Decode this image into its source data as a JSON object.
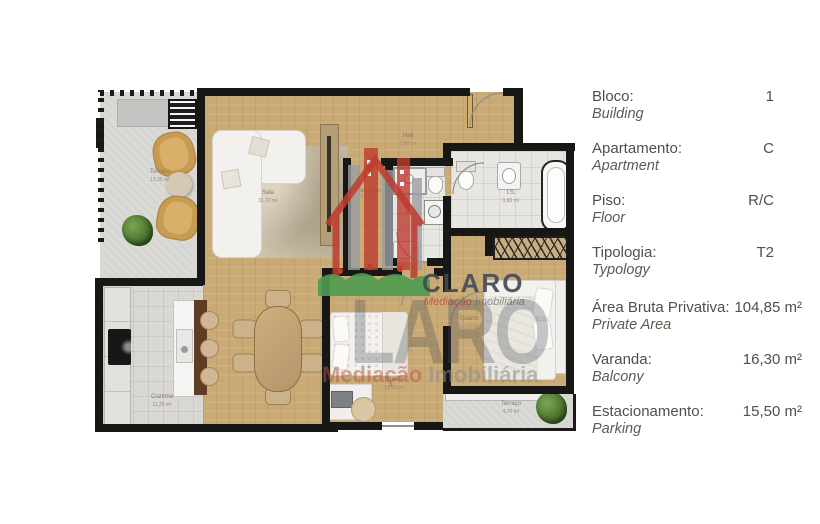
{
  "panel": {
    "rows": [
      {
        "label": "Bloco:",
        "label_en": "Building",
        "value": "1"
      },
      {
        "label": "Apartamento:",
        "label_en": "Apartment",
        "value": "C"
      },
      {
        "label": "Piso:",
        "label_en": "Floor",
        "value": "R/C"
      },
      {
        "label": "Tipologia:",
        "label_en": "Typology",
        "value": "T2"
      },
      {
        "label": "Área Bruta Privativa:",
        "label_en": "Private Area",
        "value": "104,85 m²"
      },
      {
        "label": "Varanda:",
        "label_en": "Balcony",
        "value": "16,30 m²"
      },
      {
        "label": "Estacionamento:",
        "label_en": "Parking",
        "value": "15,50 m²"
      }
    ]
  },
  "rooms": [
    {
      "name": "Terraço",
      "area": "13,35 m²"
    },
    {
      "name": "Sala",
      "area": "31,70 m²"
    },
    {
      "name": "Hall",
      "area": "7,60 m²"
    },
    {
      "name": "Circulação",
      "area": "4,20 m²"
    },
    {
      "name": "I.S.",
      "area": "3,10 m²"
    },
    {
      "name": "I.S.",
      "area": "3,90 m²"
    },
    {
      "name": "Quarto",
      "area": "13,70 m²"
    },
    {
      "name": "Quarto",
      "area": "12,05 m²"
    },
    {
      "name": "Cozinha",
      "area": "11,20 m²"
    },
    {
      "name": "Terraço",
      "area": "4,70 m²"
    }
  ],
  "watermark": {
    "brand": "CLARO",
    "brand_ghost": "LARO",
    "subtitle_word1": "Mediação",
    "subtitle_word2": " Imobiliária",
    "tagline_word1": "Mediação",
    "tagline_word2": " Imobiliária",
    "colors": {
      "logo_red": "#bf3b2f",
      "grass_green": "#4f9b50",
      "brand_slate": "#444b56",
      "wood": "#c9aa74",
      "wall": "#171715"
    }
  }
}
